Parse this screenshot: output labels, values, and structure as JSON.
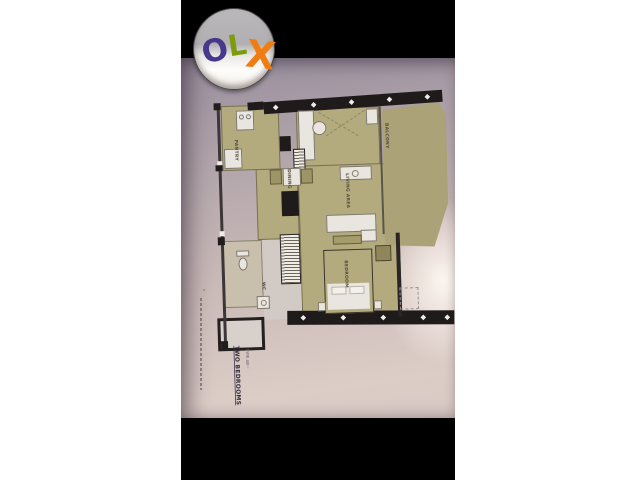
{
  "window": {
    "background": "#ffffff",
    "letterbox_color": "#000000"
  },
  "photo": {
    "description_role": "listing-photo-of-floor-plan",
    "wall_tint_top": "#978c9c",
    "wall_tint_bottom": "#dccdc7"
  },
  "olx_logo": {
    "letters": [
      {
        "char": "O",
        "color": "#46398b"
      },
      {
        "char": "L",
        "color": "#7d9c0d"
      },
      {
        "char": "X",
        "color": "#ef7d12"
      }
    ]
  },
  "floor_plan": {
    "title": "TWO BEDROOMS",
    "type_label": "TYPE AB",
    "type_label_suffix": "····",
    "footnote_marker": "*",
    "colors": {
      "floor": "#b3ab7e",
      "walls": "#1f1b1b",
      "fixtures": "#e9e5df"
    },
    "rooms": [
      {
        "label": "PANTRY"
      },
      {
        "label": "DINING"
      },
      {
        "label": "LIVING AREA"
      },
      {
        "label": "BALCONY"
      },
      {
        "label": "BEDROOM"
      },
      {
        "label": "WC"
      }
    ]
  }
}
